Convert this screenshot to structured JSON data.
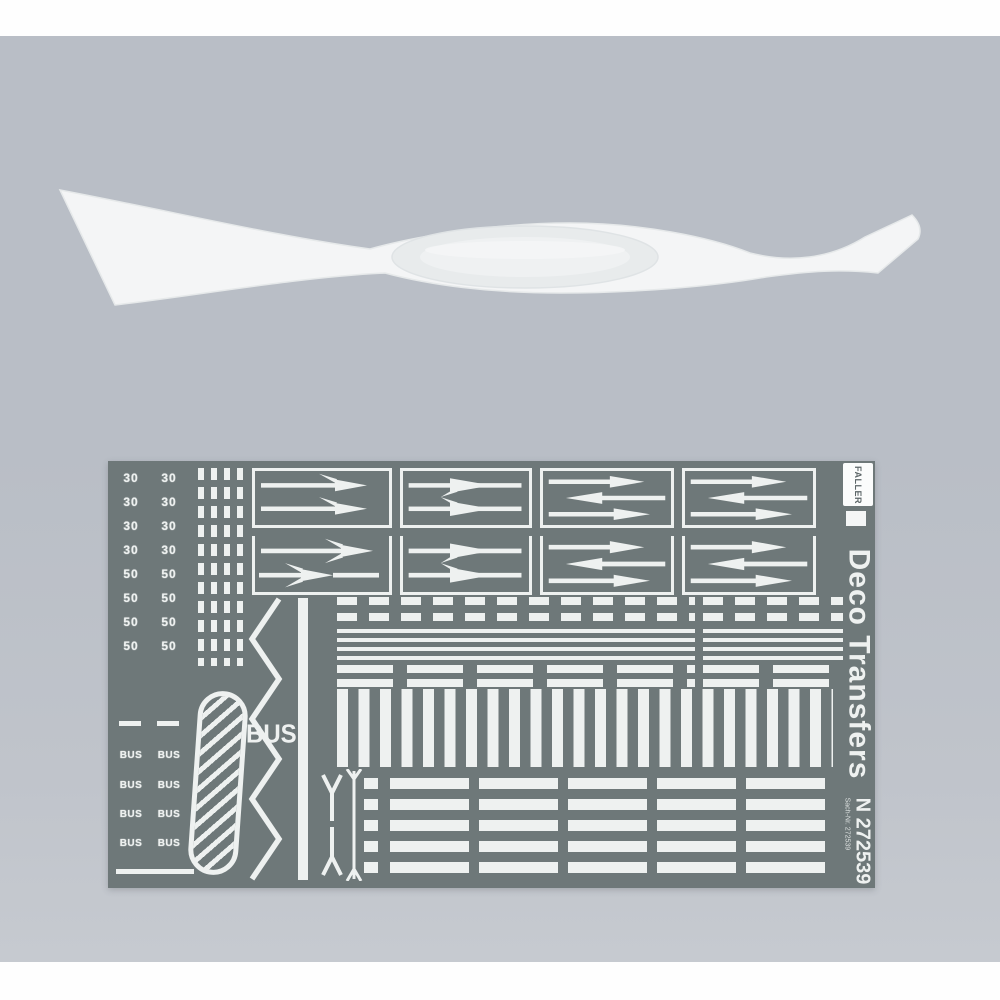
{
  "photo": {
    "background_color": "#b9bec6",
    "band_color": "#fefefe"
  },
  "tool": {
    "name": "white plastic transfer applicator",
    "color": "#f4f5f6"
  },
  "sheet": {
    "background_color": "#6e7879",
    "marking_color": "#eef1f0",
    "brand": "FALLER",
    "product_title": "Deco Transfers",
    "item_number": "N 272539",
    "item_subtext": "Sach-Nr. 272539",
    "bus_label": "BUS",
    "left_columns": {
      "rows": [
        {
          "kind": "number",
          "label": "30"
        },
        {
          "kind": "number",
          "label": "30"
        },
        {
          "kind": "number",
          "label": "30"
        },
        {
          "kind": "number",
          "label": "30"
        },
        {
          "kind": "number",
          "label": "50"
        },
        {
          "kind": "number",
          "label": "50"
        },
        {
          "kind": "number",
          "label": "50"
        },
        {
          "kind": "number",
          "label": "50"
        },
        {
          "kind": "dash",
          "label": ""
        },
        {
          "kind": "bus",
          "label": "BUS"
        },
        {
          "kind": "bus",
          "label": "BUS"
        },
        {
          "kind": "bus",
          "label": "BUS"
        },
        {
          "kind": "bus",
          "label": "BUS"
        }
      ]
    },
    "arrow_grid": {
      "boxes": [
        {
          "type": "branch-pair"
        },
        {
          "type": "mid-branch-pair"
        },
        {
          "type": "triple-straight"
        },
        {
          "type": "triple-straight"
        },
        {
          "type": "branch-pair-offset"
        },
        {
          "type": "mid-branch-pair"
        },
        {
          "type": "triple-straight"
        },
        {
          "type": "triple-straight"
        }
      ]
    }
  }
}
